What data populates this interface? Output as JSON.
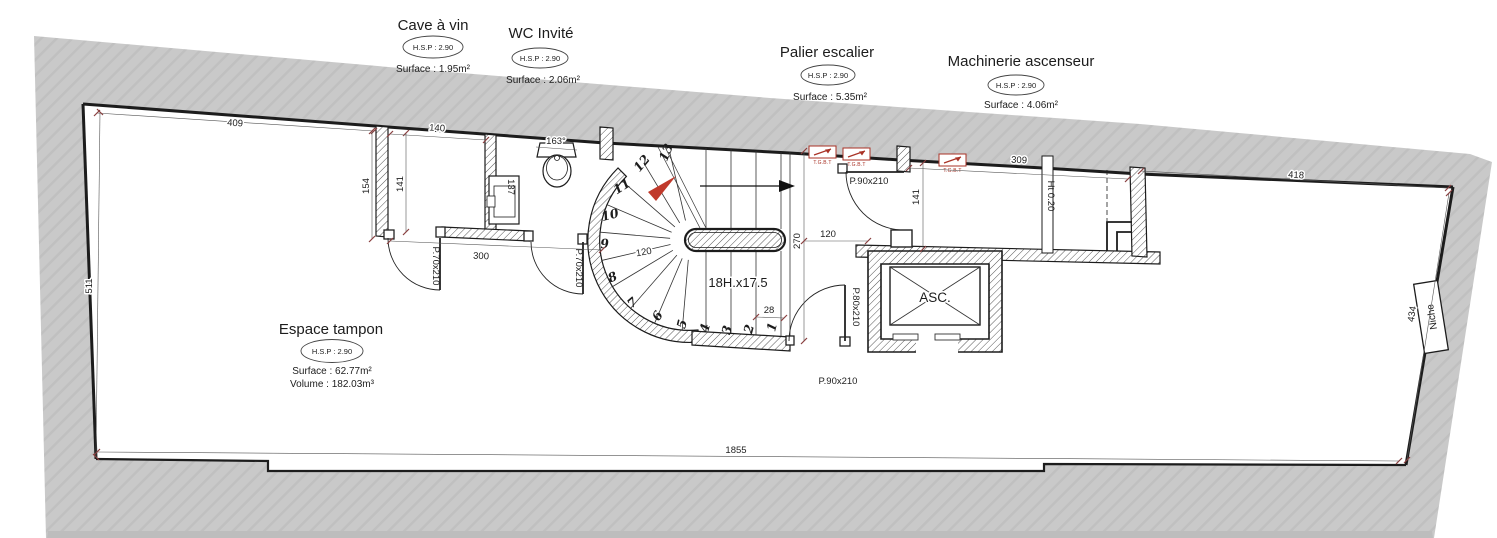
{
  "colors": {
    "band": "#c9c9c9",
    "band_hatch": "#c0c0c0",
    "wall_line": "#1c1c1c",
    "dim_tick": "#8a4040",
    "red_accent": "#c0392b"
  },
  "rooms": {
    "cave": {
      "title": "Cave à vin",
      "hsp": "H.S.P : 2.90",
      "surface": "Surface : 1.95m²"
    },
    "wc": {
      "title": "WC Invité",
      "hsp": "H.S.P : 2.90",
      "surface": "Surface : 2.06m²"
    },
    "palier": {
      "title": "Palier escalier",
      "hsp": "H.S.P : 2.90",
      "surface": "Surface : 5.35m²"
    },
    "machinerie": {
      "title": "Machinerie ascenseur",
      "hsp": "H.S.P : 2.90",
      "surface": "Surface : 4.06m²"
    },
    "tampon": {
      "title": "Espace tampon",
      "hsp": "H.S.P : 2.90",
      "surface": "Surface : 62.77m²",
      "volume": "Volume : 182.03m³"
    }
  },
  "dims": {
    "top_left": "409",
    "left": "511",
    "bottom": "1855",
    "top_right": "418",
    "right": "434",
    "cave_width": "140",
    "cave_left_h": "154",
    "cave_h": "141",
    "under_rooms": "300",
    "wc_angle": "163°",
    "sink_h": "137",
    "stair_radius": "120",
    "palier_h": "270",
    "palier_w": "120",
    "tread": "28",
    "palier_left_h": "141",
    "palier_top": "309",
    "low_wall": "Ht 0.20"
  },
  "stair": {
    "label": "18H.x17.5",
    "steps": [
      "1",
      "2",
      "3",
      "4",
      "5",
      "6",
      "7",
      "8",
      "9",
      "10",
      "11",
      "12",
      "13"
    ]
  },
  "doors": {
    "d70a": "P.70x210",
    "d70b": "P.70x210",
    "d90a": "P.90x210",
    "d80": "P.80x210",
    "d90b": "P.90x210"
  },
  "elevator": {
    "label": "ASC."
  },
  "niche": {
    "label": "Niche"
  },
  "tgbt": {
    "label": "T.G.B.T"
  }
}
